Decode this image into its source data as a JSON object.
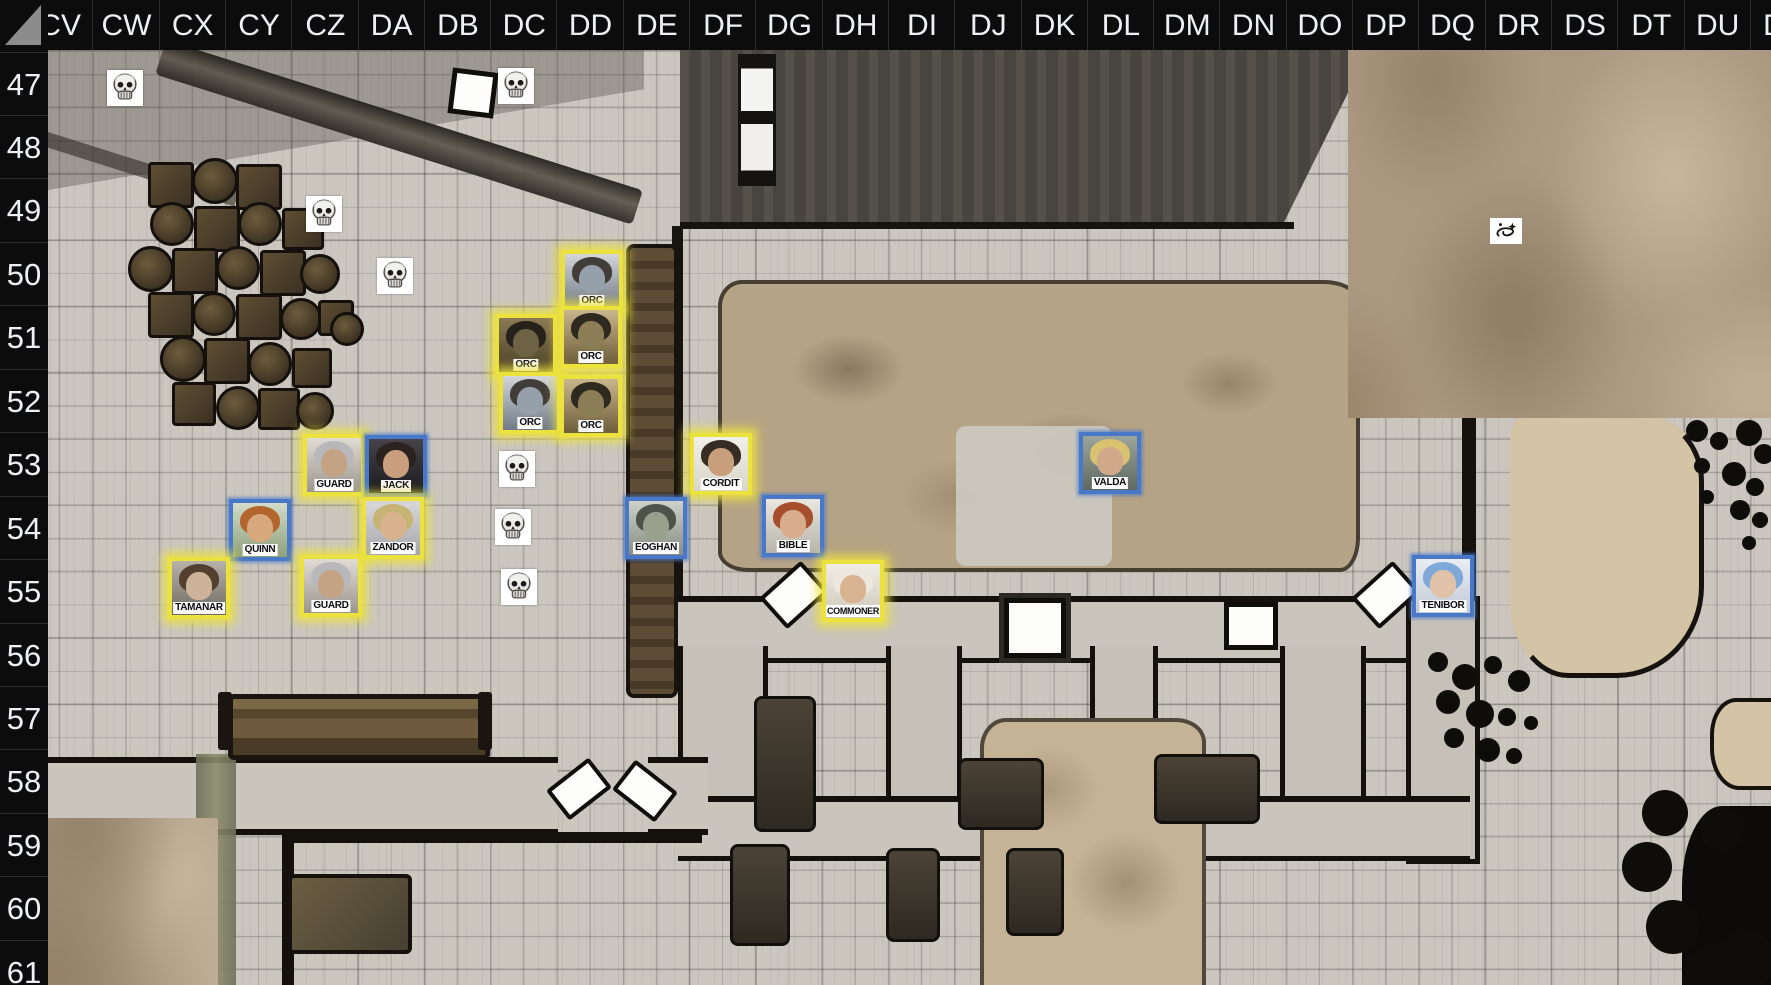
{
  "grid": {
    "columns": [
      "CV",
      "CW",
      "CX",
      "CY",
      "CZ",
      "DA",
      "DB",
      "DC",
      "DD",
      "DE",
      "DF",
      "DG",
      "DH",
      "DI",
      "DJ",
      "DK",
      "DL",
      "DM",
      "DN",
      "DO",
      "DP",
      "DQ",
      "DR",
      "DS",
      "DT",
      "DU",
      "DV"
    ],
    "rows": [
      "47",
      "48",
      "49",
      "50",
      "51",
      "52",
      "53",
      "54",
      "55",
      "56",
      "57",
      "58",
      "59",
      "60",
      "61"
    ],
    "col_origin_x": 26,
    "col_width": 66.3,
    "row_origin_y": 51.5,
    "row_height": 63.45
  },
  "colors": {
    "highlight_yellow": "#ece23e",
    "highlight_blue": "#4a78c8",
    "header_bg": "#0c0c0c",
    "header_text": "#eef0f4"
  },
  "tokens": [
    {
      "label": "ORC",
      "cell": "DD50",
      "x": 561,
      "y": 250,
      "ring": "yellow",
      "portrait": {
        "bg1": "#d3d6da",
        "bg2": "#707a86",
        "hair": "#413d38",
        "skin": "#96a0ab"
      }
    },
    {
      "label": "ORC",
      "cell": "DC51",
      "x": 495,
      "y": 314,
      "ring": "yellow",
      "portrait": {
        "bg1": "#8a7a55",
        "bg2": "#4a4028",
        "hair": "#26221b",
        "skin": "#6e6244"
      }
    },
    {
      "label": "ORC",
      "cell": "DD51",
      "x": 560,
      "y": 306,
      "ring": "yellow",
      "portrait": {
        "bg1": "#c8b68c",
        "bg2": "#6d5d3a",
        "hair": "#2e2a20",
        "skin": "#8b7d55"
      }
    },
    {
      "label": "ORC",
      "cell": "DC52",
      "x": 499,
      "y": 372,
      "ring": "yellow",
      "portrait": {
        "bg1": "#d3d6da",
        "bg2": "#707a86",
        "hair": "#413d38",
        "skin": "#96a0ab"
      }
    },
    {
      "label": "ORC",
      "cell": "DD52",
      "x": 560,
      "y": 375,
      "ring": "yellow",
      "portrait": {
        "bg1": "#c8b68c",
        "bg2": "#6d5d3a",
        "hair": "#2e2a20",
        "skin": "#8b7d55"
      }
    },
    {
      "label": "GUARD",
      "cell": "CZ53",
      "x": 303,
      "y": 434,
      "ring": "yellow",
      "portrait": {
        "bg1": "#e0dbd3",
        "bg2": "#9b968e",
        "hair": "#b8b8bc",
        "skin": "#c4a384"
      }
    },
    {
      "label": "JACK",
      "cell": "DA53",
      "x": 365,
      "y": 435,
      "ring": "blue",
      "portrait": {
        "bg1": "#46444a",
        "bg2": "#1c1b20",
        "hair": "#2a2320",
        "skin": "#c89e7d"
      }
    },
    {
      "label": "QUINN",
      "cell": "CY54",
      "x": 229,
      "y": 499,
      "ring": "blue",
      "portrait": {
        "bg1": "#d3dcc9",
        "bg2": "#8da07c",
        "hair": "#b2652c",
        "skin": "#d7a77e"
      }
    },
    {
      "label": "ZANDOR",
      "cell": "DA54",
      "x": 362,
      "y": 497,
      "ring": "yellow",
      "portrait": {
        "bg1": "#d9d9db",
        "bg2": "#a6a6ac",
        "hair": "#c6b475",
        "skin": "#d8b28d"
      }
    },
    {
      "label": "TAMANAR",
      "cell": "CX55",
      "x": 168,
      "y": 557,
      "ring": "yellow",
      "portrait": {
        "bg1": "#b8b3aa",
        "bg2": "#6e6a62",
        "hair": "#54402e",
        "skin": "#ccb399"
      }
    },
    {
      "label": "GUARD",
      "cell": "CZ55",
      "x": 300,
      "y": 555,
      "ring": "yellow",
      "portrait": {
        "bg1": "#e0dbd3",
        "bg2": "#9b968e",
        "hair": "#b8b8bc",
        "skin": "#c4a384"
      }
    },
    {
      "label": "CORDIT",
      "cell": "DF53",
      "x": 690,
      "y": 433,
      "ring": "yellow",
      "portrait": {
        "bg1": "#f0efe9",
        "bg2": "#d9d6c9",
        "hair": "#382d24",
        "skin": "#c89f7b"
      }
    },
    {
      "label": "EOGHAN",
      "cell": "DE54",
      "x": 625,
      "y": 497,
      "ring": "blue",
      "portrait": {
        "bg1": "#ced1ca",
        "bg2": "#878d83",
        "hair": "#4e5349",
        "skin": "#99a08d"
      }
    },
    {
      "label": "BIBLE",
      "cell": "DG54",
      "x": 762,
      "y": 495,
      "ring": "blue",
      "portrait": {
        "bg1": "#e9e7e0",
        "bg2": "#b8b4a9",
        "hair": "#a64f2c",
        "skin": "#d8ad8d"
      }
    },
    {
      "label": "COMMONER",
      "cell": "DH55",
      "x": 822,
      "y": 560,
      "ring": "yellow",
      "portrait": {
        "bg1": "#f0ede5",
        "bg2": "#cfc8b9",
        "hair": "#ece8e0",
        "skin": "#d8b392"
      }
    },
    {
      "label": "VALDA",
      "cell": "DL53",
      "x": 1079,
      "y": 432,
      "ring": "blue",
      "portrait": {
        "bg1": "#9ba59b",
        "bg2": "#5e6960",
        "hair": "#d8c16f",
        "skin": "#d2a88b"
      }
    },
    {
      "label": "TENIBOR",
      "cell": "DQ55",
      "x": 1412,
      "y": 555,
      "ring": "blue",
      "portrait": {
        "bg1": "#e9edf3",
        "bg2": "#c1cad7",
        "hair": "#80a9d9",
        "skin": "#dfc2a7"
      }
    }
  ],
  "skulls": [
    {
      "cell": "CW47",
      "x": 107,
      "y": 70
    },
    {
      "cell": "DC47",
      "x": 498,
      "y": 68
    },
    {
      "cell": "CY49",
      "x": 306,
      "y": 196
    },
    {
      "cell": "CZ50",
      "x": 377,
      "y": 258
    },
    {
      "cell": "DC53",
      "x": 499,
      "y": 451
    },
    {
      "cell": "DC54",
      "x": 495,
      "y": 509
    },
    {
      "cell": "DC55",
      "x": 501,
      "y": 569
    }
  ],
  "markers": [
    {
      "name": "galaxy-marker",
      "cell": "DR49",
      "x": 1490,
      "y": 218,
      "w": 32,
      "h": 26
    }
  ],
  "doors": [
    {
      "x": 450,
      "y": 70,
      "w": 36,
      "h": 36,
      "rot": 7,
      "style": "square",
      "framed": false
    },
    {
      "x": 1004,
      "y": 598,
      "w": 52,
      "h": 50,
      "rot": 0,
      "style": "square",
      "framed": true
    },
    {
      "x": 1224,
      "y": 602,
      "w": 44,
      "h": 38,
      "rot": 0,
      "style": "square",
      "framed": false
    },
    {
      "x": 766,
      "y": 574,
      "w": 48,
      "h": 34,
      "rot": -42,
      "style": "angled",
      "framed": false
    },
    {
      "x": 1358,
      "y": 574,
      "w": 48,
      "h": 34,
      "rot": -42,
      "style": "angled",
      "framed": false
    },
    {
      "x": 552,
      "y": 770,
      "w": 46,
      "h": 30,
      "rot": -38,
      "style": "angled",
      "framed": false
    },
    {
      "x": 618,
      "y": 772,
      "w": 46,
      "h": 30,
      "rot": 38,
      "style": "angled",
      "framed": false
    }
  ],
  "decor": {
    "barrels": [
      {
        "x": 148,
        "y": 162,
        "s": 40,
        "shape": "crate"
      },
      {
        "x": 192,
        "y": 158,
        "s": 40,
        "shape": "barrel"
      },
      {
        "x": 236,
        "y": 164,
        "s": 40,
        "shape": "crate"
      },
      {
        "x": 150,
        "y": 202,
        "s": 38,
        "shape": "barrel"
      },
      {
        "x": 194,
        "y": 206,
        "s": 40,
        "shape": "crate"
      },
      {
        "x": 238,
        "y": 202,
        "s": 38,
        "shape": "barrel"
      },
      {
        "x": 282,
        "y": 208,
        "s": 36,
        "shape": "crate"
      },
      {
        "x": 128,
        "y": 246,
        "s": 40,
        "shape": "barrel"
      },
      {
        "x": 172,
        "y": 248,
        "s": 40,
        "shape": "crate"
      },
      {
        "x": 216,
        "y": 246,
        "s": 38,
        "shape": "barrel"
      },
      {
        "x": 260,
        "y": 250,
        "s": 40,
        "shape": "crate"
      },
      {
        "x": 300,
        "y": 254,
        "s": 34,
        "shape": "barrel"
      },
      {
        "x": 148,
        "y": 292,
        "s": 40,
        "shape": "crate"
      },
      {
        "x": 192,
        "y": 292,
        "s": 38,
        "shape": "barrel"
      },
      {
        "x": 236,
        "y": 294,
        "s": 40,
        "shape": "crate"
      },
      {
        "x": 280,
        "y": 298,
        "s": 36,
        "shape": "barrel"
      },
      {
        "x": 318,
        "y": 300,
        "s": 30,
        "shape": "crate"
      },
      {
        "x": 160,
        "y": 336,
        "s": 40,
        "shape": "barrel"
      },
      {
        "x": 204,
        "y": 338,
        "s": 40,
        "shape": "crate"
      },
      {
        "x": 248,
        "y": 342,
        "s": 38,
        "shape": "barrel"
      },
      {
        "x": 292,
        "y": 348,
        "s": 34,
        "shape": "crate"
      },
      {
        "x": 172,
        "y": 382,
        "s": 38,
        "shape": "crate"
      },
      {
        "x": 216,
        "y": 386,
        "s": 38,
        "shape": "barrel"
      },
      {
        "x": 258,
        "y": 388,
        "s": 36,
        "shape": "crate"
      },
      {
        "x": 296,
        "y": 392,
        "s": 32,
        "shape": "barrel"
      },
      {
        "x": 330,
        "y": 312,
        "s": 28,
        "shape": "barrel"
      }
    ],
    "beds": [
      {
        "x": 754,
        "y": 696,
        "w": 56,
        "h": 130
      },
      {
        "x": 958,
        "y": 758,
        "w": 80,
        "h": 66
      },
      {
        "x": 1154,
        "y": 754,
        "w": 100,
        "h": 64
      },
      {
        "x": 730,
        "y": 844,
        "w": 54,
        "h": 96
      },
      {
        "x": 886,
        "y": 848,
        "w": 48,
        "h": 88
      },
      {
        "x": 1006,
        "y": 848,
        "w": 52,
        "h": 82
      }
    ],
    "rocks": [
      {
        "x": 1686,
        "y": 420,
        "s": 22
      },
      {
        "x": 1710,
        "y": 432,
        "s": 18
      },
      {
        "x": 1736,
        "y": 420,
        "s": 26
      },
      {
        "x": 1754,
        "y": 444,
        "s": 20
      },
      {
        "x": 1694,
        "y": 458,
        "s": 16
      },
      {
        "x": 1722,
        "y": 462,
        "s": 24
      },
      {
        "x": 1746,
        "y": 478,
        "s": 18
      },
      {
        "x": 1700,
        "y": 490,
        "s": 14
      },
      {
        "x": 1730,
        "y": 500,
        "s": 20
      },
      {
        "x": 1752,
        "y": 512,
        "s": 16
      },
      {
        "x": 1742,
        "y": 536,
        "s": 14
      },
      {
        "x": 1428,
        "y": 652,
        "s": 20
      },
      {
        "x": 1452,
        "y": 664,
        "s": 26
      },
      {
        "x": 1484,
        "y": 656,
        "s": 18
      },
      {
        "x": 1508,
        "y": 670,
        "s": 22
      },
      {
        "x": 1436,
        "y": 690,
        "s": 24
      },
      {
        "x": 1466,
        "y": 700,
        "s": 28
      },
      {
        "x": 1498,
        "y": 708,
        "s": 18
      },
      {
        "x": 1444,
        "y": 728,
        "s": 20
      },
      {
        "x": 1476,
        "y": 738,
        "s": 24
      },
      {
        "x": 1506,
        "y": 748,
        "s": 16
      },
      {
        "x": 1524,
        "y": 716,
        "s": 14
      },
      {
        "x": 1642,
        "y": 790,
        "s": 46
      },
      {
        "x": 1622,
        "y": 842,
        "s": 50
      },
      {
        "x": 1646,
        "y": 900,
        "s": 54
      },
      {
        "x": 1684,
        "y": 944,
        "s": 60
      },
      {
        "x": 1716,
        "y": 930,
        "s": 60
      },
      {
        "x": 1700,
        "y": 808,
        "s": 44
      }
    ]
  }
}
